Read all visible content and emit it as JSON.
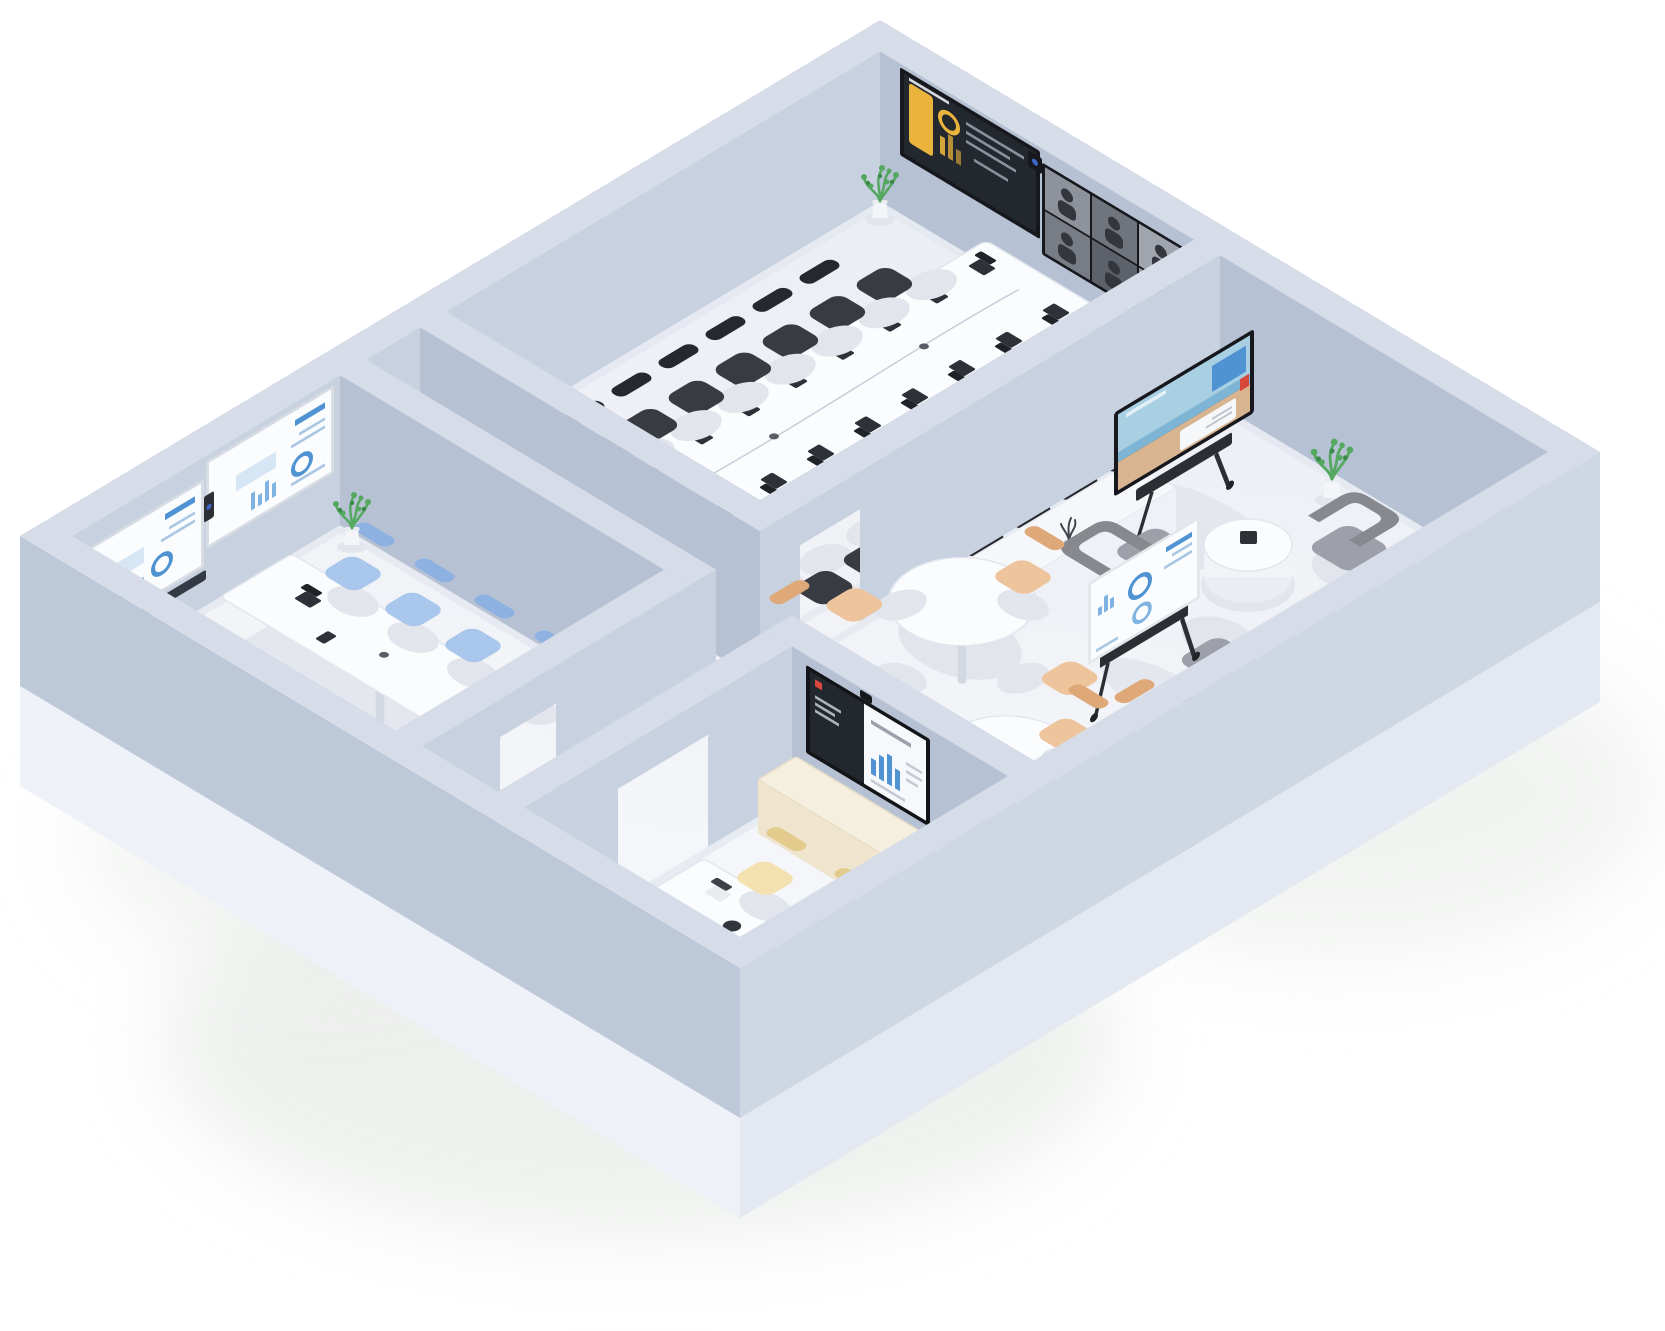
{
  "meta": {
    "title": "Isometric 3D office floor plan render",
    "style": "3d-isometric",
    "background": "#ffffff"
  },
  "palette": {
    "wallTop": "#d6dce8",
    "wallFaceU": "#c8d1e0",
    "wallFaceV": "#b6c1d4",
    "wallOuterU": "#cfd7e3",
    "wallOuterV": "#bdc9d9",
    "slabU": "#e3e8f1",
    "slabV": "#eef1f7",
    "floorLight": "#edeff4",
    "floorBright": "#f6f7fa",
    "tableTop": "#fbfcfe",
    "tableEdge": "#e2e6ed",
    "tableShade": "#e4e7ee",
    "shadow": "#e2e5ec",
    "chairBlack": "#383b41",
    "chairBlackDark": "#26282d",
    "chairBlue": "#a9c6ec",
    "chairBlueDark": "#8db1e0",
    "chairTan": "#eec49c",
    "chairTanDark": "#dfa878",
    "chairCream": "#f3e2b0",
    "chairCreamDark": "#e3cb8e",
    "loungeGray": "#9da0a8",
    "loungeGrayDark": "#87898f",
    "bezelDark": "#16181d",
    "screenDark": "#23272e",
    "accentYellow": "#e9b33c",
    "accentBlue": "#4f93d2",
    "accentBlueLight": "#a9c6e4",
    "accentRed": "#d8473c",
    "screenWhite": "#fbfcfe",
    "credenzaCream": "#f5efdf",
    "credenzaCreamFace": "#efe5cf",
    "credenzaCreamEnd": "#e7dcc2",
    "credenzaWhite": "#f6f7fa",
    "credenzaWhiteFace": "#eef1f6",
    "credenzaWhiteEnd": "#e7ebf2",
    "plantGreen": "#54a85f",
    "plantGreenDark": "#3c8a49",
    "potWhite": "#f3f5f8",
    "glow": "#e7ebe7"
  },
  "scene": {
    "rooms": [
      {
        "id": "boardroom",
        "name": "Boardroom",
        "furniture": "Long white conference table with 17 black chairs, table laptops and microphones, corner plant",
        "equipment": "Dual wall displays: analytics dashboard (yellow on dark) and 6-tile video call grid, center camera"
      },
      {
        "id": "meeting-room",
        "name": "Meeting room",
        "furniture": "White conference table with 8 light-blue chairs, laptop and speakerphone, corner plant",
        "equipment": "Dual wall-mounted interactive whiteboards with blue charts and center video camera"
      },
      {
        "id": "huddle-room",
        "name": "Huddle room",
        "furniture": "Small white table with 4 cream chairs, beige sideboard, laptop, tablet and speakerphone",
        "equipment": "Wall display showing presentation slide (dark panel + blue bar chart) with camera"
      },
      {
        "id": "open-space",
        "name": "Open collaboration space",
        "furniture": "Two round tables with 8 tan chairs, gray lounge set with round coffee table, white credenza",
        "equipment": "Mobile display cart with media screen, mobile whiteboard with blue charts, tabletop speakerphone"
      }
    ],
    "counts": {
      "plants": 3,
      "wall_displays": 5,
      "mobile_screens": 2,
      "chairs_total": 32
    }
  }
}
